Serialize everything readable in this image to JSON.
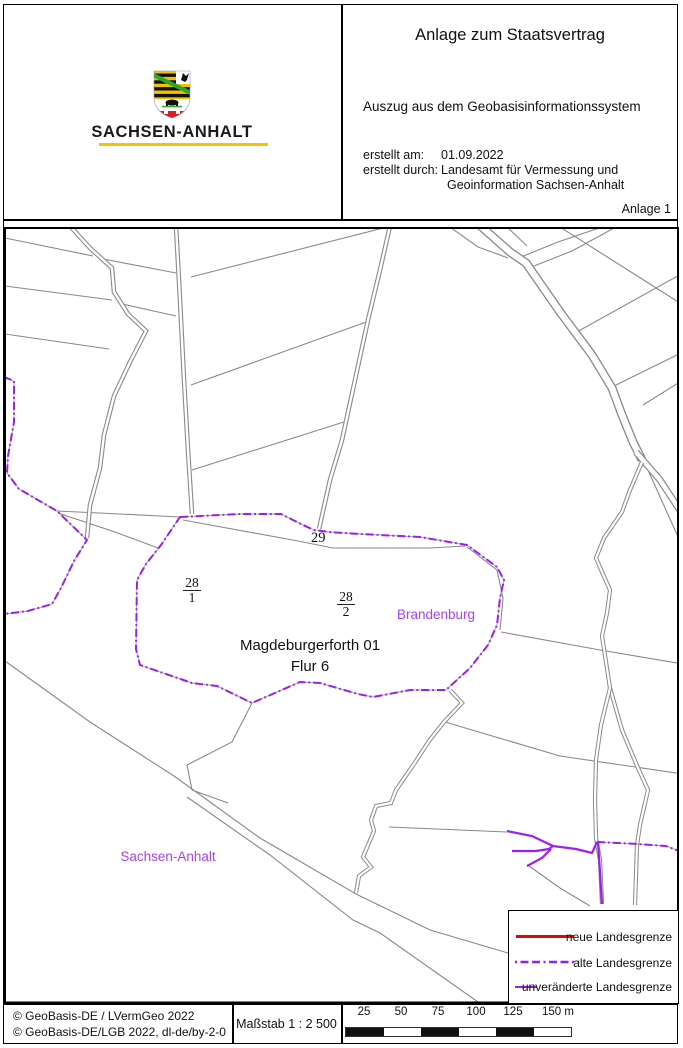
{
  "header": {
    "wordmark": "SACHSEN-ANHALT",
    "title": "Anlage zum Staatsvertrag",
    "subtitle": "Auszug aus dem Geobasisinformationssystem",
    "created_label": "erstellt am:",
    "created_value": "01.09.2022",
    "author_label": "erstellt durch:",
    "author_value_line1": "Landesamt für Vermessung und",
    "author_value_line2": "Geoinformation Sachsen-Anhalt",
    "annex": "Anlage 1"
  },
  "map": {
    "labels": {
      "parcel_top": "29",
      "parcel_left_num": "28",
      "parcel_left_den": "1",
      "parcel_center_num": "28",
      "parcel_center_den": "2",
      "area_line1": "Magdeburgerforth 01",
      "area_line2": "Flur 6",
      "state_right": "Brandenburg",
      "state_left": "Sachsen-Anhalt"
    },
    "colors": {
      "boundary_purple": "#9C1FEC",
      "state_label_purple": "#A843F0",
      "parcel_gray": "#8a8a8a",
      "new_boundary_red": "#DD0808",
      "logo_yellow": "#F5C400"
    }
  },
  "legend": {
    "items": [
      {
        "label": "neue Landesgrenze",
        "style": "solid-red"
      },
      {
        "label": "alte Landesgrenze",
        "style": "dashdot-purple"
      },
      {
        "label": "unveränderte Landesgrenze",
        "style": "solid-purple"
      }
    ]
  },
  "footer": {
    "copyright1": "© GeoBasis-DE / LVermGeo 2022",
    "copyright2": "© GeoBasis-DE/LGB 2022, dl-de/by-2-0",
    "scale_text": "Maßstab 1 : 2 500",
    "scalebar_ticks": [
      "25",
      "50",
      "75",
      "100",
      "125",
      "150 m"
    ]
  }
}
